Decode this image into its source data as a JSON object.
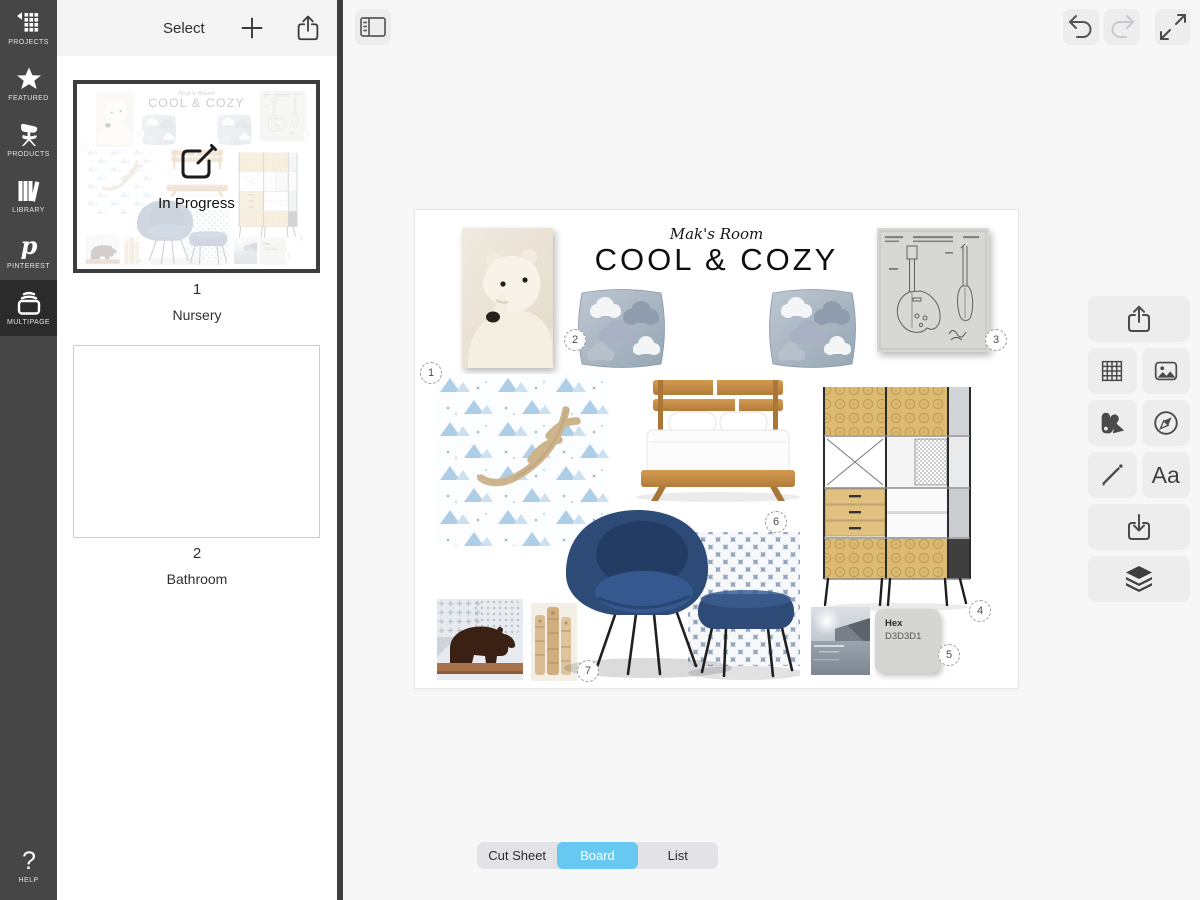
{
  "rail": {
    "items": [
      {
        "label": "PROJECTS",
        "icon": "projects-grid-icon"
      },
      {
        "label": "FEATURED",
        "icon": "star-icon"
      },
      {
        "label": "PRODUCTS",
        "icon": "chair-icon"
      },
      {
        "label": "LIBRARY",
        "icon": "books-icon"
      },
      {
        "label": "PINTEREST",
        "icon": "pinterest-icon"
      },
      {
        "label": "MULTIPAGE",
        "icon": "multipage-icon",
        "selected": true
      }
    ],
    "help": {
      "label": "HELP",
      "icon": "question-icon"
    }
  },
  "pages_panel": {
    "select_label": "Select",
    "pages": [
      {
        "number": "1",
        "name": "Nursery",
        "status": "In Progress"
      },
      {
        "number": "2",
        "name": "Bathroom"
      }
    ]
  },
  "board": {
    "subtitle": "Mak's Room",
    "title": "COOL & COZY",
    "badges": [
      "1",
      "2",
      "3",
      "4",
      "5",
      "6",
      "7"
    ],
    "swatch": {
      "label": "Hex",
      "value": "D3D3D1"
    },
    "images": [
      "polar-bear-photo",
      "cloud-pillow-left",
      "cloud-pillow-right",
      "guitar-patent-print",
      "mountain-wallpaper-with-antler",
      "wood-platform-bed",
      "eames-storage-unit",
      "navy-womb-chair-and-ottoman",
      "polka-dot-fabric",
      "bear-sculpture-photo",
      "carved-totem-photo",
      "seascape-photo",
      "hex-color-swatch"
    ]
  },
  "toolbar": {
    "text_tool_glyph": "Aa"
  },
  "view_switcher": {
    "options": [
      "Cut Sheet",
      "Board",
      "List"
    ],
    "selected": "Board"
  },
  "colors": {
    "rail_bg": "#464646",
    "rail_selected_bg": "#2b2b2b",
    "canvas_bg": "#f7f7f8",
    "accent_selected_segment": "#67c9f2",
    "swatch_hex": "#D3D3D1"
  }
}
